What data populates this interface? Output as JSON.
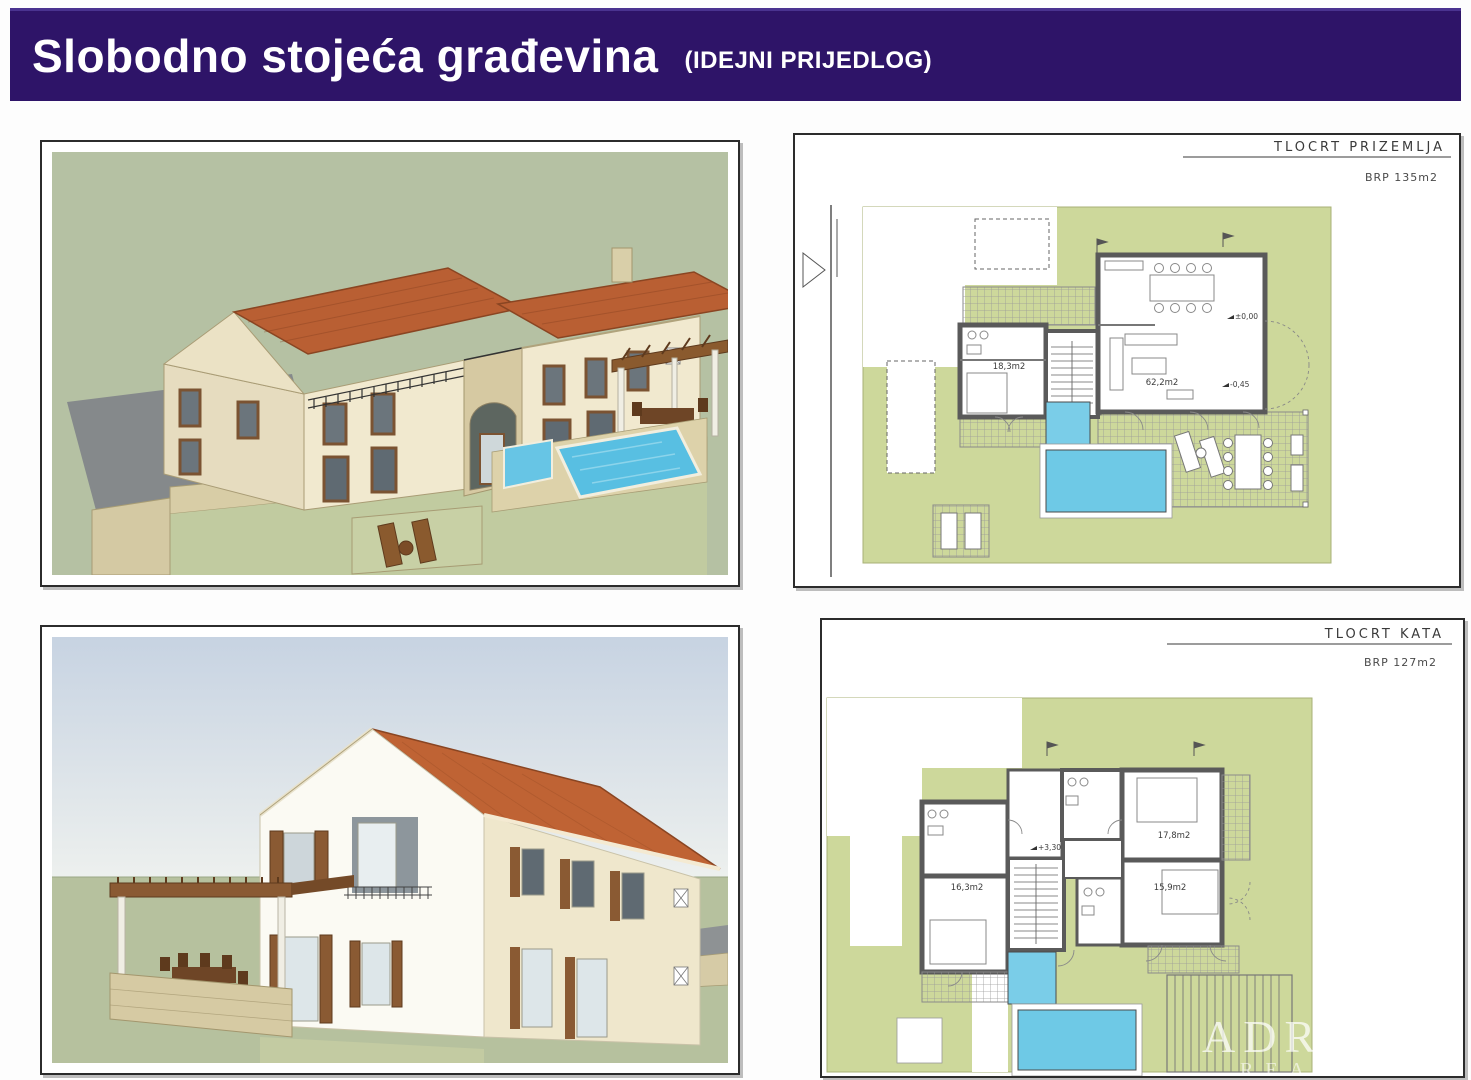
{
  "header": {
    "title": "Slobodno stojeća građevina",
    "subtitle": "(IDEJNI PRIJEDLOG)"
  },
  "plans": {
    "ground": {
      "title": "TLOCRT PRIZEMLJA",
      "brp": "BRP 135m2",
      "rooms": {
        "bedroom": "18,3m2",
        "living": "62,2m2"
      },
      "levels": {
        "zero": "±0,00",
        "terrace": "-0,45"
      }
    },
    "upper": {
      "title": "TLOCRT KATA",
      "brp": "BRP 127m2",
      "rooms": {
        "bedroom_w": "16,3m2",
        "bedroom_ne": "17,8m2",
        "bedroom_e": "15,9m2"
      },
      "levels": {
        "floor": "+3,30"
      }
    }
  },
  "watermark": {
    "line1": "ADRIATIC",
    "line2": "REAL ESTATE"
  },
  "colors": {
    "header_bg": "#2e1468",
    "site_green": "#cdd89b",
    "pool_blue": "#6ec9e6",
    "roof_terracotta": "#b95f33",
    "wall_cream": "#f1e9cf",
    "backdrop_sage": "#b5c1a3",
    "sky_blue": "#c7d3e2"
  }
}
